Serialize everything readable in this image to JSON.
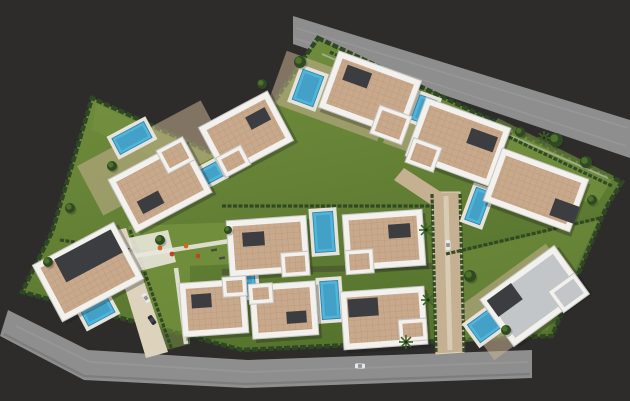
{
  "meta": {
    "title": "3D aerial site-plan rendering of a villa development"
  },
  "colors": {
    "bg": "#2d2c2b",
    "road": "#8e8e8e",
    "roadDark": "#6f6f70",
    "roadStripe": "#a8a8a8",
    "curb": "#c9c9c7",
    "lawn": "#5f7d33",
    "lawnLight": "#7d9a44",
    "hedge": "#2e4724",
    "hedgeDark": "#203319",
    "roofTan": "#c9a98c",
    "roofTile": "#ae8d6f",
    "parapet": "#f2f1ee",
    "parapetShadow": "#c7c5c1",
    "roofDark": "#3c3d41",
    "roofGrayLight": "#c2c6c9",
    "pool": "#4fb5d9",
    "poolDeep": "#2d7ca8",
    "poolDeck": "#e6e3da",
    "paving": "#c6b092",
    "pavingLight": "#ddd3bd",
    "path": "#e9e6db",
    "tree": "#2e4a21",
    "treeLight": "#567a2e",
    "palm": "#3e6326",
    "playEquip": "#d2691e",
    "playEquipAlt": "#b9452c",
    "carWhite": "#e8e8e8",
    "carDark": "#2e2e34",
    "shadow": "#1c1c1a"
  },
  "scene": {
    "estate": {
      "outline": [
        [
          318,
          38
        ],
        [
          622,
          182
        ],
        [
          606,
          208
        ],
        [
          552,
          336
        ],
        [
          242,
          350
        ],
        [
          22,
          292
        ],
        [
          52,
          232
        ],
        [
          92,
          98
        ],
        [
          232,
          162
        ]
      ],
      "innerCurbs": [
        [
          322,
          54,
          608,
          178
        ]
      ],
      "lightBands": [
        {
          "pts": [
            [
              96,
              104
            ],
            [
              228,
              164
            ],
            [
              218,
              186
            ],
            [
              92,
              130
            ]
          ],
          "opacity": 0.3
        }
      ]
    },
    "roads": {
      "top": {
        "shape": [
          [
            293,
            16
          ],
          [
            630,
            120
          ],
          [
            630,
            158
          ],
          [
            293,
            44
          ]
        ],
        "streaks": [
          [
            [
              296,
              28
            ],
            [
              628,
              128
            ]
          ],
          [
            [
              294,
              38
            ],
            [
              626,
              146
            ]
          ]
        ]
      },
      "bottom": {
        "shape": [
          [
            8,
            310
          ],
          [
            88,
            350
          ],
          [
            248,
            360
          ],
          [
            532,
            350
          ],
          [
            532,
            378
          ],
          [
            246,
            388
          ],
          [
            84,
            380
          ],
          [
            0,
            336
          ]
        ],
        "streaks": [
          [
            [
              16,
              326
            ],
            [
              90,
              362
            ],
            [
              250,
              372
            ],
            [
              528,
              362
            ]
          ]
        ],
        "edge": [
          [
            4,
            334
          ],
          [
            84,
            376
          ],
          [
            246,
            384
          ],
          [
            530,
            374
          ]
        ]
      }
    },
    "streets": {
      "vertical": [
        [
          432,
          192
        ],
        [
          460,
          192
        ],
        [
          464,
          352
        ],
        [
          436,
          354
        ]
      ],
      "junction": [
        [
          404,
          168
        ],
        [
          444,
          194
        ],
        [
          433,
          206
        ],
        [
          394,
          180
        ]
      ],
      "left": [
        [
          108,
          232
        ],
        [
          126,
          228
        ],
        [
          168,
          352
        ],
        [
          146,
          358
        ]
      ]
    },
    "hedges": [
      [
        330,
        52,
        612,
        186
      ],
      [
        446,
        254,
        600,
        218
      ],
      [
        222,
        206,
        434,
        206
      ],
      [
        432,
        194,
        436,
        352
      ],
      [
        460,
        194,
        464,
        352
      ],
      [
        130,
        230,
        172,
        350
      ],
      [
        60,
        240,
        146,
        252
      ]
    ],
    "lawnPatches": [
      {
        "pts": [
          [
            498,
            118
          ],
          [
            614,
            176
          ],
          [
            596,
            206
          ],
          [
            470,
            156
          ]
        ],
        "opacity": 0.5
      },
      {
        "pts": [
          [
            128,
            226
          ],
          [
            238,
            222
          ],
          [
            238,
            264
          ],
          [
            190,
            266
          ],
          [
            190,
            344
          ],
          [
            166,
            350
          ]
        ],
        "opacity": 0.55
      },
      {
        "pts": [
          [
            446,
            256
          ],
          [
            598,
            220
          ],
          [
            548,
            330
          ],
          [
            452,
            344
          ]
        ],
        "opacity": 0.35
      }
    ],
    "terraces": [
      {
        "x": 332,
        "y": 96,
        "w": 116,
        "h": 54,
        "rot": 20
      },
      {
        "x": 440,
        "y": 138,
        "w": 104,
        "h": 48,
        "rot": 20
      },
      {
        "x": 152,
        "y": 158,
        "w": 140,
        "h": 56,
        "rot": -28
      },
      {
        "x": 520,
        "y": 302,
        "w": 110,
        "h": 64,
        "rot": -36
      }
    ],
    "paths": [
      [
        [
          134,
          256
        ],
        [
          236,
          240
        ]
      ],
      [
        [
          176,
          268
        ],
        [
          186,
          344
        ]
      ]
    ],
    "plaza": [
      [
        128,
        238
      ],
      [
        168,
        230
      ],
      [
        176,
        262
      ],
      [
        136,
        272
      ]
    ],
    "shadowLines": [
      [
        [
          222,
          272
        ],
        [
          432,
          266
        ]
      ]
    ],
    "villas": [
      {
        "x": 370,
        "y": 94,
        "w": 88,
        "h": 60,
        "rot": 20,
        "roof": "tan",
        "wing": [
          30,
          22,
          34,
          30
        ],
        "dark": [
          -18,
          -12,
          26,
          16
        ]
      },
      {
        "x": 458,
        "y": 142,
        "w": 90,
        "h": 62,
        "rot": 20,
        "roof": "tan",
        "wing": [
          -28,
          24,
          30,
          26
        ],
        "dark": [
          22,
          -10,
          28,
          16
        ]
      },
      {
        "x": 536,
        "y": 190,
        "w": 92,
        "h": 56,
        "rot": 20,
        "roof": "tan",
        "wing": null,
        "dark": [
          34,
          10,
          26,
          18
        ]
      },
      {
        "x": 160,
        "y": 186,
        "w": 86,
        "h": 60,
        "rot": -28,
        "roof": "tan",
        "wing": [
          28,
          -20,
          30,
          26
        ],
        "dark": [
          -16,
          10,
          24,
          14
        ]
      },
      {
        "x": 246,
        "y": 134,
        "w": 78,
        "h": 56,
        "rot": -28,
        "roof": "tan",
        "wing": [
          -24,
          18,
          28,
          22
        ],
        "dark": [
          18,
          -8,
          22,
          14
        ]
      },
      {
        "x": 88,
        "y": 272,
        "w": 92,
        "h": 64,
        "rot": -28,
        "roof": "tan",
        "wing": null,
        "dark": [
          8,
          -14,
          64,
          26
        ]
      },
      {
        "x": 268,
        "y": 246,
        "w": 80,
        "h": 56,
        "rot": -4,
        "roof": "tan",
        "wing": [
          26,
          20,
          28,
          24
        ],
        "dark": [
          -14,
          -8,
          22,
          14
        ]
      },
      {
        "x": 384,
        "y": 240,
        "w": 80,
        "h": 56,
        "rot": -4,
        "roof": "tan",
        "wing": [
          -26,
          20,
          28,
          24
        ],
        "dark": [
          16,
          -8,
          22,
          14
        ]
      },
      {
        "x": 214,
        "y": 308,
        "w": 66,
        "h": 54,
        "rot": -4,
        "roof": "tan",
        "wing": [
          22,
          -20,
          24,
          20
        ],
        "dark": [
          -12,
          -8,
          20,
          14
        ]
      },
      {
        "x": 284,
        "y": 310,
        "w": 66,
        "h": 54,
        "rot": -4,
        "roof": "tan",
        "wing": [
          -22,
          -18,
          24,
          20
        ],
        "dark": [
          12,
          8,
          20,
          12
        ]
      },
      {
        "x": 384,
        "y": 318,
        "w": 84,
        "h": 58,
        "rot": -4,
        "roof": "tan",
        "wing": [
          28,
          14,
          28,
          22
        ],
        "dark": [
          -20,
          -12,
          30,
          18
        ]
      },
      {
        "x": 534,
        "y": 296,
        "w": 92,
        "h": 58,
        "rot": -36,
        "roof": "gray",
        "wing": [
          30,
          18,
          32,
          26
        ],
        "dark": [
          -26,
          -14,
          30,
          20
        ]
      }
    ],
    "pools": [
      {
        "x": 308,
        "y": 88,
        "w": 22,
        "h": 32,
        "rot": 20
      },
      {
        "x": 424,
        "y": 110,
        "w": 18,
        "h": 26,
        "rot": 20
      },
      {
        "x": 478,
        "y": 206,
        "w": 16,
        "h": 34,
        "rot": 20
      },
      {
        "x": 132,
        "y": 138,
        "w": 36,
        "h": 18,
        "rot": -28
      },
      {
        "x": 206,
        "y": 176,
        "w": 32,
        "h": 16,
        "rot": -28
      },
      {
        "x": 98,
        "y": 312,
        "w": 30,
        "h": 16,
        "rot": -28
      },
      {
        "x": 324,
        "y": 232,
        "w": 20,
        "h": 40,
        "rot": -4
      },
      {
        "x": 330,
        "y": 300,
        "w": 18,
        "h": 38,
        "rot": -4
      },
      {
        "x": 249,
        "y": 282,
        "w": 12,
        "h": 28,
        "rot": -4
      },
      {
        "x": 490,
        "y": 322,
        "w": 40,
        "h": 22,
        "rot": -36
      }
    ],
    "trees": {
      "round": [
        [
          300,
          62,
          6
        ],
        [
          262,
          84,
          5
        ],
        [
          112,
          166,
          5
        ],
        [
          70,
          208,
          5
        ],
        [
          556,
          140,
          7
        ],
        [
          586,
          162,
          6
        ],
        [
          520,
          132,
          5
        ],
        [
          592,
          200,
          5
        ],
        [
          470,
          276,
          6
        ],
        [
          506,
          330,
          5
        ],
        [
          48,
          262,
          5
        ],
        [
          160,
          240,
          5
        ],
        [
          228,
          230,
          4
        ]
      ],
      "palm": [
        [
          426,
          230
        ],
        [
          428,
          300
        ],
        [
          406,
          342
        ],
        [
          544,
          138
        ]
      ]
    },
    "cars": [
      {
        "x": 146,
        "y": 298,
        "rot": 56,
        "color": "carWhite"
      },
      {
        "x": 152,
        "y": 320,
        "rot": 56,
        "color": "carDark"
      },
      {
        "x": 360,
        "y": 366,
        "rot": 2,
        "color": "carWhite"
      },
      {
        "x": 448,
        "y": 245,
        "rot": 88,
        "color": "carWhite"
      }
    ],
    "playground": [
      [
        160,
        248
      ],
      [
        172,
        254
      ],
      [
        186,
        246
      ],
      [
        198,
        256
      ]
    ],
    "benches": [
      [
        214,
        250
      ],
      [
        222,
        258
      ]
    ]
  }
}
